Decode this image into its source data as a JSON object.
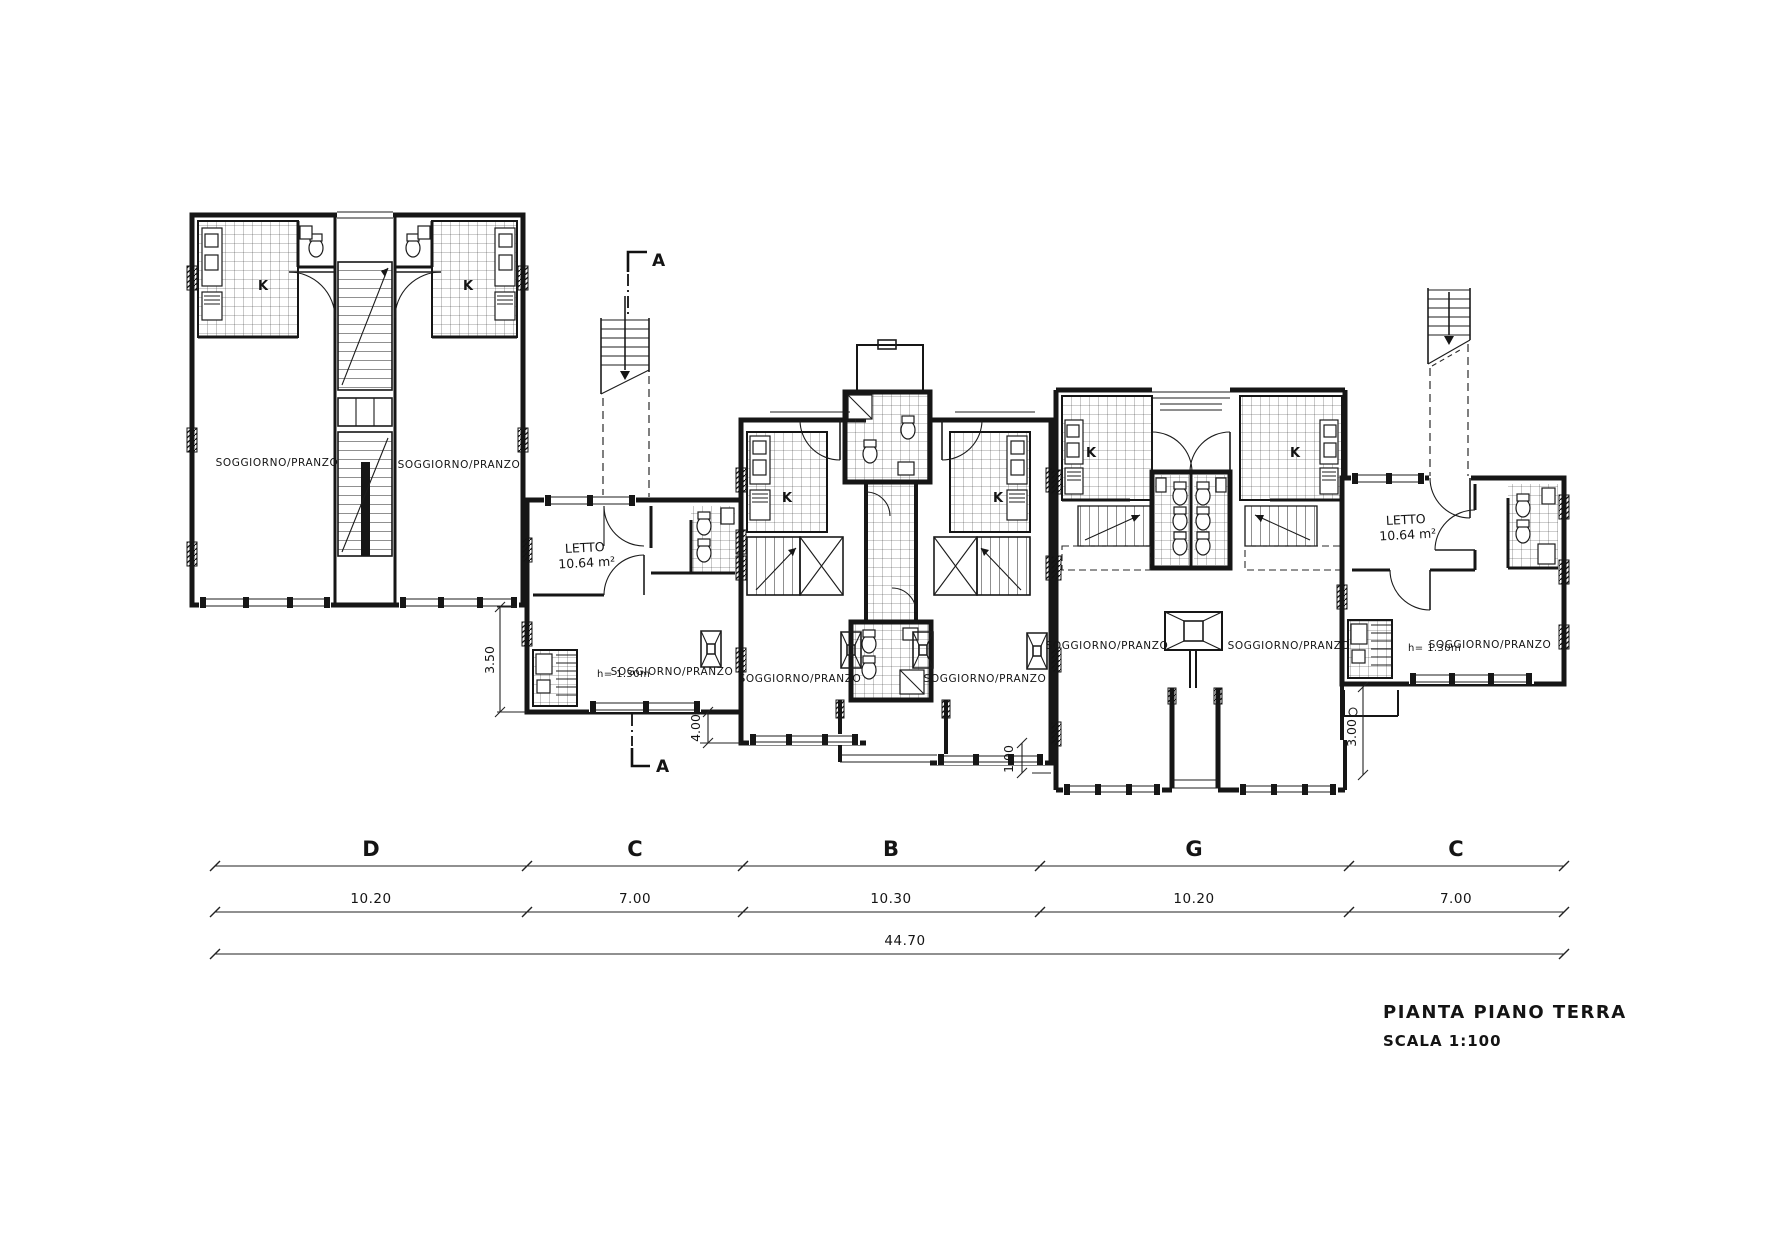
{
  "drawing": {
    "background": "#ffffff",
    "ink": "#161616"
  },
  "title_block": {
    "title": "PIANTA PIANO TERRA",
    "scale": "SCALA 1:100"
  },
  "section_marker": {
    "letter": "A"
  },
  "rooms": {
    "soggiorno_pranzo": "SOGGIORNO/PRANZO",
    "letto": "LETTO",
    "letto_area": "10.64 m²",
    "kitchen_k": "K",
    "height_note": "h= 1.30m"
  },
  "dimensions": {
    "sections": [
      {
        "label": "D",
        "length": "10.20"
      },
      {
        "label": "C",
        "length": "7.00"
      },
      {
        "label": "B",
        "length": "10.30"
      },
      {
        "label": "G",
        "length": "10.20"
      },
      {
        "label": "C",
        "length": "7.00"
      }
    ],
    "total": "44.70",
    "verticals": [
      {
        "name": "front-offset-d",
        "value": "3.50"
      },
      {
        "name": "front-offset-c1",
        "value": "4.00"
      },
      {
        "name": "front-offset-b",
        "value": "1.00"
      },
      {
        "name": "front-offset-c2",
        "value": "3.00"
      }
    ]
  }
}
